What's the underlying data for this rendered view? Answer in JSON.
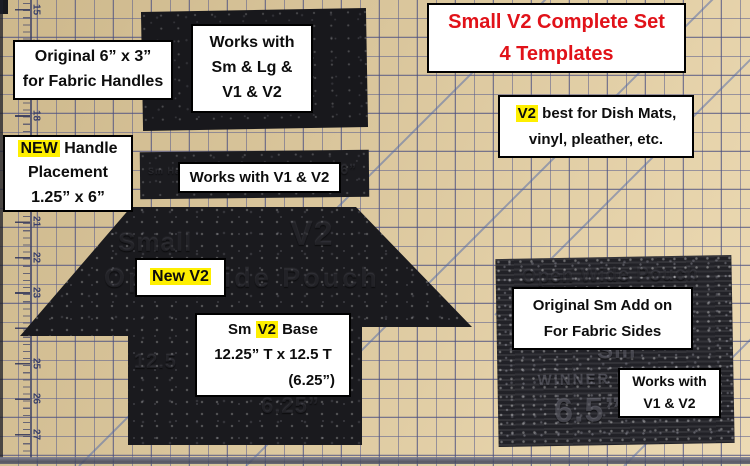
{
  "colors": {
    "mat_tan": "#d8c49a",
    "grid_blue": "#585c8e",
    "template_black": "#1b1b1f",
    "label_bg": "#ffffff",
    "label_border": "#000000",
    "title_red": "#e11219",
    "highlight_yellow": "#feef00"
  },
  "title": {
    "line1": "Small V2 Complete Set",
    "line2": "4 Templates"
  },
  "labels": {
    "original_6x3": {
      "line1": "Original 6” x 3”",
      "line2": "for Fabric Handles"
    },
    "works_sm_lg": {
      "line1": "Works with",
      "line2": "Sm & Lg &",
      "line3": "V1 & V2"
    },
    "new_handle": {
      "hl": "NEW",
      "line1_rest": " Handle",
      "line2": "Placement",
      "line3": "1.25” x 6”"
    },
    "works_v1v2_mid": {
      "line1": "Works with V1 & V2"
    },
    "v2_best": {
      "hl": "V2",
      "line1_rest": " best for Dish Mats,",
      "line2": "vinyl, pleather, etc."
    },
    "new_v2": {
      "text": "New V2"
    },
    "sm_v2_base": {
      "pre": "Sm ",
      "hl": "V2",
      "post": " Base",
      "line2": "12.25” T x 12.5 T",
      "line3": "(6.25”)"
    },
    "original_sm_addon": {
      "line1": "Original Sm Add on",
      "line2": "For Fabric Sides"
    },
    "works_v1v2_br": {
      "line1": "Works with",
      "line2": "V1 & V2"
    }
  },
  "templates": {
    "arrow": {
      "embossed_small": "Small",
      "embossed_v2": "V2",
      "embossed_mid": "Open Wide Pouch",
      "embossed_125": "12.5",
      "embossed_625": "6.25”"
    },
    "strip": {
      "embossed_left": "Sm Handle",
      "embossed_right": "6”"
    },
    "square": {
      "embossed_top": "Open Wide Pouch",
      "embossed_sm": "Sm",
      "embossed_winner": "WINNER D",
      "embossed_65": "6.5”"
    }
  },
  "ruler": {
    "numbers": [
      "15",
      "16",
      "17",
      "18",
      "19",
      "20",
      "21",
      "22",
      "23",
      "24",
      "25",
      "26",
      "27"
    ]
  }
}
